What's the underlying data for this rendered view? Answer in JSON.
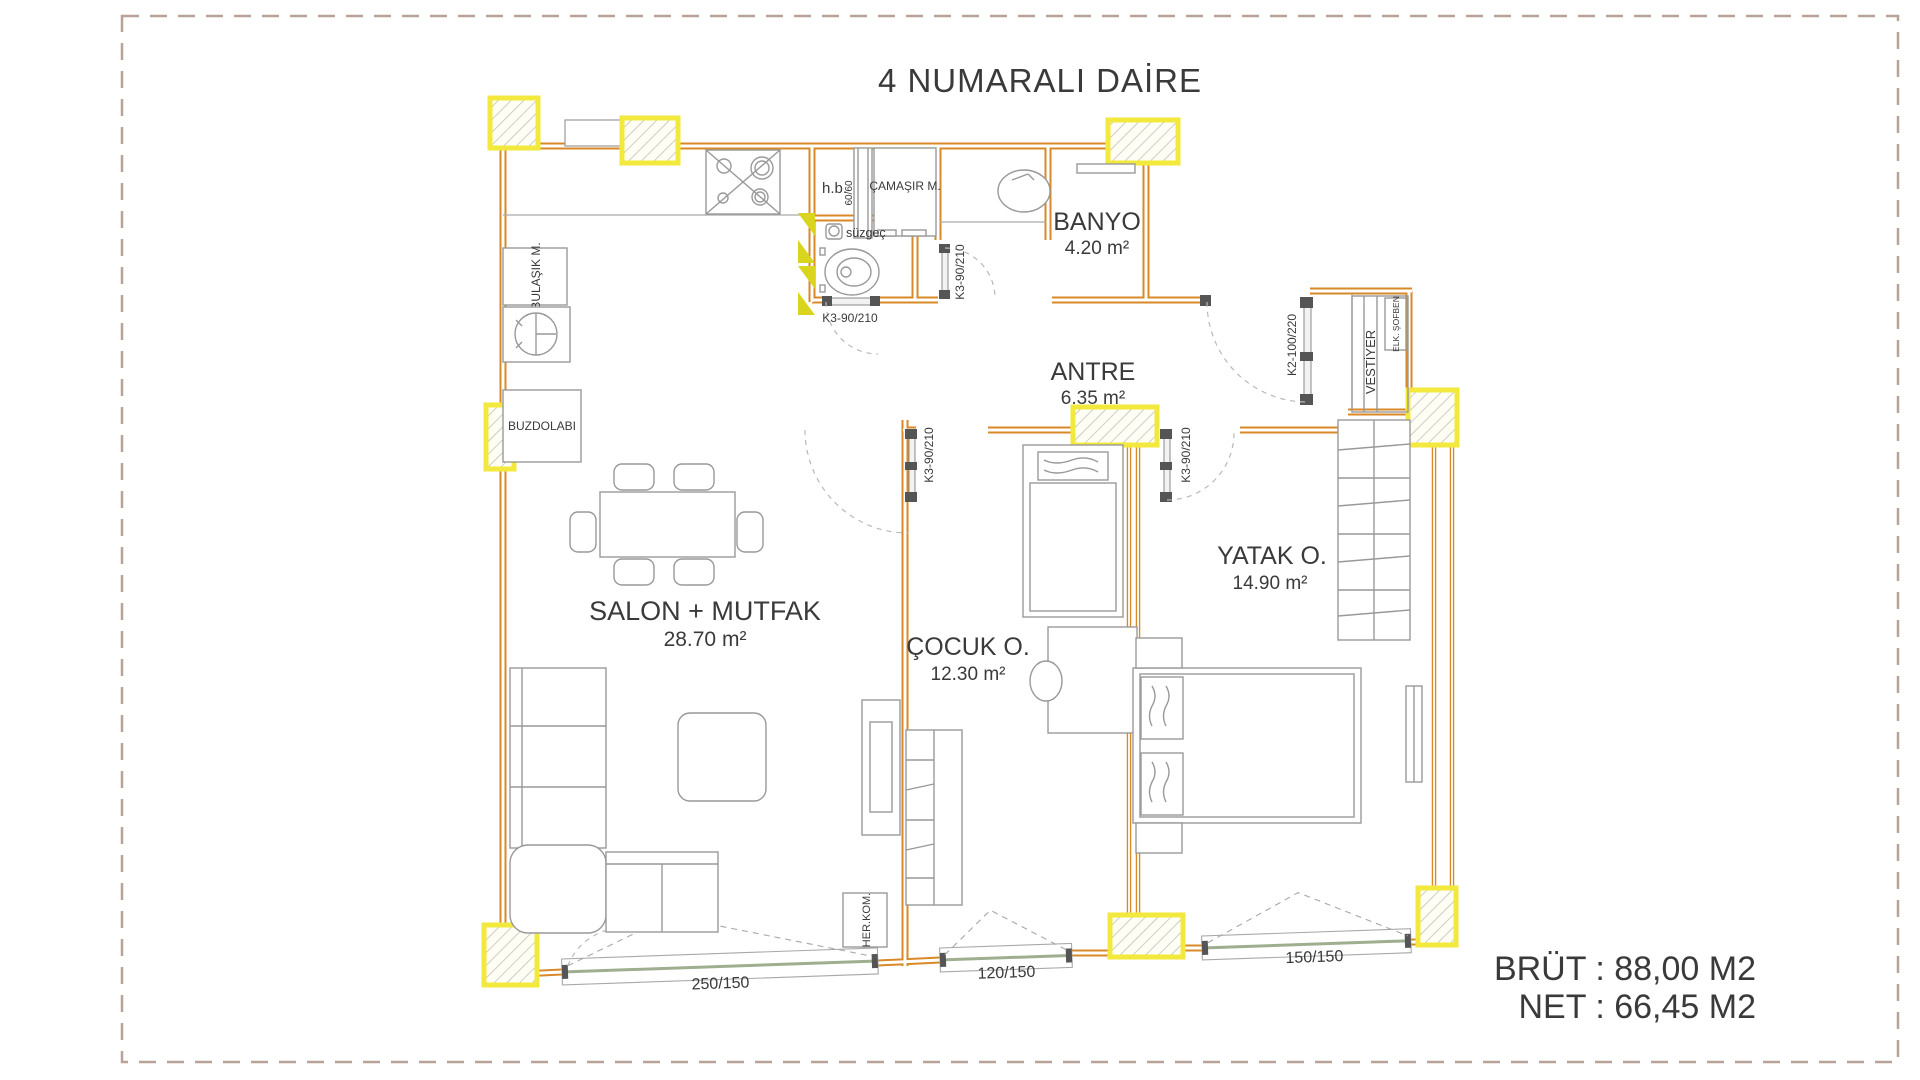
{
  "title": "4 NUMARALI DAİRE",
  "totals": {
    "brut": "BRÜT : 88,00 M2",
    "net": "NET : 66,45 M2"
  },
  "rooms": {
    "salon": {
      "name": "SALON + MUTFAK",
      "area": "28.70 m²"
    },
    "cocuk": {
      "name": "ÇOCUK O.",
      "area": "12.30 m²"
    },
    "yatak": {
      "name": "YATAK O.",
      "area": "14.90 m²"
    },
    "antre": {
      "name": "ANTRE",
      "area": "6.35 m²"
    },
    "banyo": {
      "name": "BANYO",
      "area": "4.20 m²"
    }
  },
  "fixtures": {
    "bulasik": "BULAŞIK M.",
    "buzdolabi": "BUZDOLABI",
    "camasir": "ÇAMAŞIR M.",
    "hb": "h.b.",
    "dus": "60/60",
    "suzgec": "süzgeç",
    "vestiyer": "VESTİYER",
    "sofben": "ELK. ŞOFBEN",
    "herkom": "HER.KOM."
  },
  "doors": {
    "wc": "K3-90/210",
    "banyo": "K3-90/210",
    "cocuk": "K3-90/210",
    "yatak": "K3-90/210",
    "entry": "K2-100/220"
  },
  "windows": {
    "salon": "250/150",
    "cocuk": "120/150",
    "yatak": "150/150"
  },
  "colors": {
    "wall": "#d98a28",
    "block_yellow": "#f2e93c",
    "furniture_gray": "#999999",
    "text": "#3a3a3a",
    "border_dash": "#b7a397"
  }
}
